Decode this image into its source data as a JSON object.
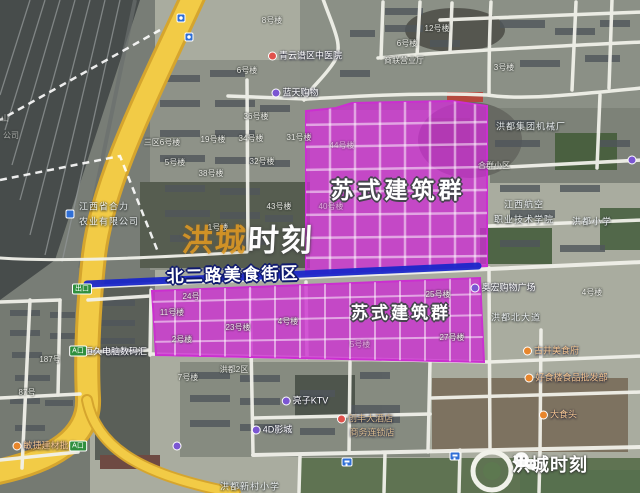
{
  "annotations": {
    "zone_label_upper": "苏式建筑群",
    "zone_label_lower": "苏式建筑群",
    "street_zone_label": "北二路美食街区",
    "watermark_part1": "洪城",
    "watermark_part2": "时刻",
    "logo_text": "洪城时刻",
    "logo_icon": "wechat-icon"
  },
  "colors": {
    "magenta": "#cb2fd0",
    "blue_line": "#1a27c9",
    "road_yellow": "#f2cb46",
    "road_yellow_edge": "#d5a52e",
    "sign_green": "#2f8f3e",
    "poi_purple": "#7b56d2",
    "poi_red": "#e0514b",
    "poi_orange": "#e8862c",
    "poi_blue": "#2f6fd6",
    "watermark_orange": "#e09b25"
  },
  "signs": [
    {
      "text": "出口",
      "x": 82,
      "y": 289
    },
    {
      "text": "A口",
      "x": 78,
      "y": 351
    },
    {
      "text": "A口",
      "x": 78,
      "y": 446
    }
  ],
  "road_shields": [
    {
      "x": 181,
      "y": 18
    },
    {
      "x": 189,
      "y": 37
    }
  ],
  "bus_stops": [
    {
      "x": 347,
      "y": 462
    },
    {
      "x": 455,
      "y": 456
    }
  ],
  "map_labels": [
    {
      "text": "8号楼",
      "x": 272,
      "y": 21,
      "cls": "bldg",
      "name": "building-number-label"
    },
    {
      "text": "12号楼",
      "x": 437,
      "y": 29,
      "cls": "bldg",
      "name": "building-number-label"
    },
    {
      "text": "6号楼",
      "x": 407,
      "y": 44,
      "cls": "bldg",
      "name": "building-number-label"
    },
    {
      "text": "商联营业厅",
      "x": 404,
      "y": 61,
      "cls": "bldg",
      "name": "business-hall-label"
    },
    {
      "text": "3号楼",
      "x": 504,
      "y": 68,
      "cls": "bldg",
      "name": "building-number-label"
    },
    {
      "text": "6号楼",
      "x": 247,
      "y": 71,
      "cls": "bldg",
      "name": "building-number-label"
    },
    {
      "text": "36号楼",
      "x": 256,
      "y": 117,
      "cls": "bldg",
      "name": "building-number-label"
    },
    {
      "text": "三区6号楼",
      "x": 162,
      "y": 143,
      "cls": "bldg",
      "name": "building-number-label"
    },
    {
      "text": "19号楼",
      "x": 213,
      "y": 140,
      "cls": "bldg",
      "name": "building-number-label"
    },
    {
      "text": "34号楼",
      "x": 251,
      "y": 139,
      "cls": "bldg",
      "name": "building-number-label"
    },
    {
      "text": "5号楼",
      "x": 175,
      "y": 163,
      "cls": "bldg",
      "name": "building-number-label"
    },
    {
      "text": "32号楼",
      "x": 262,
      "y": 162,
      "cls": "bldg",
      "name": "building-number-label"
    },
    {
      "text": "38号楼",
      "x": 211,
      "y": 174,
      "cls": "bldg",
      "name": "building-number-label"
    },
    {
      "text": "43号楼",
      "x": 279,
      "y": 207,
      "cls": "bldg",
      "name": "building-number-label"
    },
    {
      "text": "1号楼",
      "x": 218,
      "y": 228,
      "cls": "bldg",
      "name": "building-number-label"
    },
    {
      "text": "31号楼",
      "x": 299,
      "y": 138,
      "cls": "bldg",
      "name": "building-number-label"
    },
    {
      "text": "44号楼",
      "x": 342,
      "y": 146,
      "cls": "bldg faint",
      "name": "building-number-label"
    },
    {
      "text": "40号楼",
      "x": 331,
      "y": 207,
      "cls": "bldg faint",
      "name": "building-number-label"
    },
    {
      "text": "合群小区",
      "x": 494,
      "y": 166,
      "cls": "bldg",
      "name": "residential-area-label"
    },
    {
      "text": "4号楼",
      "x": 592,
      "y": 293,
      "cls": "bldg",
      "name": "building-number-label"
    },
    {
      "text": "7号楼",
      "x": 188,
      "y": 378,
      "cls": "bldg",
      "name": "building-number-label"
    },
    {
      "text": "洪都2区",
      "x": 234,
      "y": 370,
      "cls": "bldg",
      "name": "residential-area-label"
    },
    {
      "text": "187号",
      "x": 50,
      "y": 360,
      "cls": "bldg",
      "name": "building-number-label"
    },
    {
      "text": "87号",
      "x": 27,
      "y": 393,
      "cls": "bldg",
      "name": "building-number-label"
    },
    {
      "text": "山",
      "x": 5,
      "y": 119,
      "cls": "bldg faint",
      "name": "edge-clipped-label"
    },
    {
      "text": "公司",
      "x": 11,
      "y": 136,
      "cls": "bldg faint",
      "name": "edge-clipped-label"
    },
    {
      "text": "24号",
      "x": 191,
      "y": 297,
      "cls": "bldg",
      "name": "building-number-label"
    },
    {
      "text": "11号楼",
      "x": 172,
      "y": 313,
      "cls": "bldg",
      "name": "building-number-label"
    },
    {
      "text": "2号楼",
      "x": 182,
      "y": 340,
      "cls": "bldg",
      "name": "building-number-label"
    },
    {
      "text": "23号楼",
      "x": 238,
      "y": 328,
      "cls": "bldg",
      "name": "building-number-label"
    },
    {
      "text": "4号楼",
      "x": 288,
      "y": 322,
      "cls": "bldg",
      "name": "building-number-label"
    },
    {
      "text": "25号楼",
      "x": 438,
      "y": 295,
      "cls": "bldg",
      "name": "building-number-label"
    },
    {
      "text": "27号楼",
      "x": 452,
      "y": 338,
      "cls": "bldg",
      "name": "building-number-label"
    },
    {
      "text": "5号楼",
      "x": 360,
      "y": 345,
      "cls": "bldg faint",
      "name": "building-number-label"
    },
    {
      "text": "洪都集团机械厂",
      "x": 531,
      "y": 127,
      "cls": "street",
      "name": "factory-label"
    },
    {
      "text": "江西航空",
      "x": 524,
      "y": 205,
      "cls": "street",
      "name": "college-label-line1"
    },
    {
      "text": "职业技术学院",
      "x": 524,
      "y": 220,
      "cls": "street",
      "name": "college-label-line2"
    },
    {
      "text": "洪都小学",
      "x": 592,
      "y": 222,
      "cls": "street",
      "name": "school-label"
    },
    {
      "text": "洪都北大道",
      "x": 516,
      "y": 318,
      "cls": "street",
      "name": "street-name-label"
    },
    {
      "text": "江西省合力",
      "x": 104,
      "y": 207,
      "cls": "street",
      "name": "company-label-line1"
    },
    {
      "text": "农业有限公司",
      "x": 109,
      "y": 222,
      "cls": "street",
      "name": "company-label-line2"
    },
    {
      "text": "洪都新村小学",
      "x": 250,
      "y": 487,
      "cls": "street faint",
      "name": "school-label"
    },
    {
      "text": "青云谱区中医院",
      "x": 305,
      "y": 56,
      "cls": "poi",
      "icon": "red",
      "name": "hospital-poi-label"
    },
    {
      "text": "蓝天购物",
      "x": 295,
      "y": 93,
      "cls": "poi",
      "icon": "purple",
      "name": "mall-poi-label"
    },
    {
      "text": "奥宏购物广场",
      "x": 503,
      "y": 288,
      "cls": "poi",
      "icon": "purple",
      "name": "mall-poi-label"
    },
    {
      "text": "恒久电脑数码汇",
      "x": 110,
      "y": 352,
      "cls": "poi",
      "icon": "purple",
      "name": "computer-mall-poi-label"
    },
    {
      "text": "亮子KTV",
      "x": 305,
      "y": 401,
      "cls": "poi",
      "icon": "purple",
      "name": "ktv-poi-label"
    },
    {
      "text": "4D影城",
      "x": 272,
      "y": 430,
      "cls": "poi",
      "icon": "purple",
      "name": "cinema-poi-label"
    },
    {
      "text": "创丰大酒店",
      "x": 365,
      "y": 419,
      "cls": "poi tan",
      "icon": "red",
      "name": "hotel-poi-label"
    },
    {
      "text": "商务连锁店",
      "x": 372,
      "y": 433,
      "cls": "poi tan",
      "name": "hotel-poi-label-line2"
    },
    {
      "text": "古井美食府",
      "x": 551,
      "y": 351,
      "cls": "poi orange",
      "icon": "orange",
      "name": "food-poi-label"
    },
    {
      "text": "好食楼食品批发部",
      "x": 566,
      "y": 378,
      "cls": "poi orange",
      "icon": "orange",
      "name": "food-poi-label"
    },
    {
      "text": "大食头",
      "x": 558,
      "y": 415,
      "cls": "poi orange",
      "icon": "orange",
      "name": "food-poi-label"
    },
    {
      "text": "敏捷建材批发",
      "x": 45,
      "y": 446,
      "cls": "poi orange",
      "icon": "orange",
      "name": "market-poi-label"
    },
    {
      "text": "",
      "x": 70,
      "y": 214,
      "cls": "poi",
      "icon": "blue",
      "name": "company-poi-icon"
    },
    {
      "text": "",
      "x": 632,
      "y": 160,
      "cls": "poi",
      "icon": "purple",
      "name": "poi-icon"
    },
    {
      "text": "",
      "x": 177,
      "y": 446,
      "cls": "poi",
      "icon": "purple",
      "name": "poi-icon"
    }
  ]
}
